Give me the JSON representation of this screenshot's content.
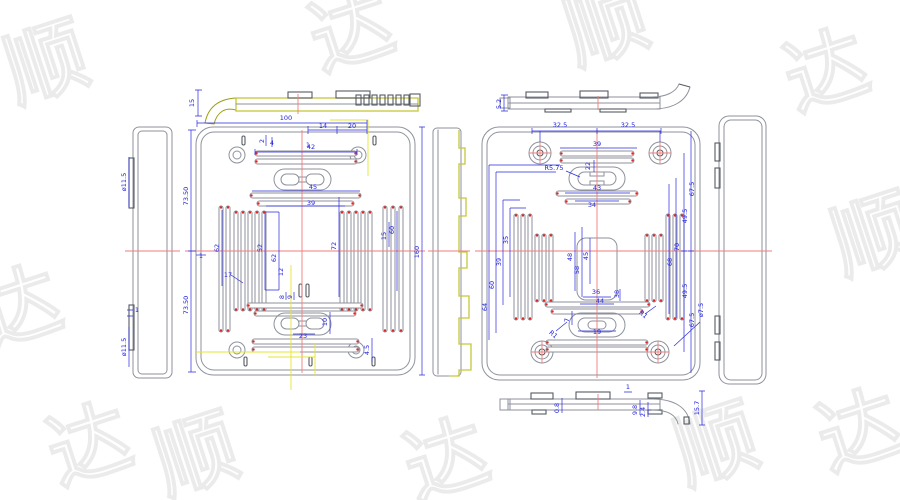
{
  "drawing": {
    "type": "cad-engineering-drawing",
    "parts": [
      "mold-plate-left",
      "mold-plate-right"
    ],
    "colors": {
      "background": "#ffffff",
      "dimension_blue": "#2222dd",
      "geometry_gray": "#8d929b",
      "geometry_dark": "#565b63",
      "highlight_yellow": "#c6c63a",
      "centerline_red": "#f27d7d",
      "marker_red": "#e02424",
      "watermark_gray": "#ebebeb"
    },
    "watermark": {
      "chars": [
        "顺",
        "达"
      ],
      "positions": [
        {
          "x": 55,
          "y": 90,
          "r": -18,
          "c": 0
        },
        {
          "x": 360,
          "y": 58,
          "r": -18,
          "c": 1
        },
        {
          "x": 615,
          "y": 52,
          "r": -18,
          "c": 0
        },
        {
          "x": 835,
          "y": 98,
          "r": -18,
          "c": 1
        },
        {
          "x": 28,
          "y": 335,
          "r": -18,
          "c": 1
        },
        {
          "x": 882,
          "y": 262,
          "r": -18,
          "c": 0
        },
        {
          "x": 205,
          "y": 482,
          "r": -18,
          "c": 0
        },
        {
          "x": 455,
          "y": 487,
          "r": -18,
          "c": 1
        },
        {
          "x": 725,
          "y": 472,
          "r": -18,
          "c": 0
        },
        {
          "x": 98,
          "y": 472,
          "r": -18,
          "c": 1
        },
        {
          "x": 868,
          "y": 458,
          "r": -18,
          "c": 1
        }
      ]
    },
    "dimensions": [
      {
        "t": "15",
        "x": 194,
        "y": 103,
        "r": -90
      },
      {
        "t": "ø11.5",
        "x": 126,
        "y": 182,
        "r": -90
      },
      {
        "t": "1",
        "x": 137,
        "y": 312,
        "r": 0
      },
      {
        "t": "ø11.5",
        "x": 126,
        "y": 347,
        "r": -90
      },
      {
        "t": "100",
        "x": 286,
        "y": 120,
        "r": 0
      },
      {
        "t": "14",
        "x": 323,
        "y": 128,
        "r": 0
      },
      {
        "t": "20",
        "x": 352,
        "y": 128,
        "r": 0
      },
      {
        "t": "2",
        "x": 264,
        "y": 141,
        "r": -90
      },
      {
        "t": "4",
        "x": 272,
        "y": 145,
        "r": 0
      },
      {
        "t": "1",
        "x": 308,
        "y": 147,
        "r": 0
      },
      {
        "t": "42",
        "x": 311,
        "y": 149,
        "r": 0
      },
      {
        "t": "1",
        "x": 201,
        "y": 258,
        "r": 0
      },
      {
        "t": "45",
        "x": 313,
        "y": 189,
        "r": 0
      },
      {
        "t": "39",
        "x": 311,
        "y": 205,
        "r": 0
      },
      {
        "t": "62",
        "x": 219,
        "y": 248,
        "r": -90
      },
      {
        "t": "52",
        "x": 262,
        "y": 248,
        "r": -90
      },
      {
        "t": "62",
        "x": 276,
        "y": 258,
        "r": -90
      },
      {
        "t": "12",
        "x": 283,
        "y": 272,
        "r": -90
      },
      {
        "t": "17",
        "x": 228,
        "y": 277,
        "r": 0
      },
      {
        "t": "72",
        "x": 336,
        "y": 246,
        "r": -90
      },
      {
        "t": "15",
        "x": 386,
        "y": 236,
        "r": -90
      },
      {
        "t": "60",
        "x": 394,
        "y": 230,
        "r": -90
      },
      {
        "t": "160",
        "x": 419,
        "y": 252,
        "r": -90
      },
      {
        "t": "73.50",
        "x": 188,
        "y": 196,
        "r": -90
      },
      {
        "t": "73.50",
        "x": 188,
        "y": 305,
        "r": -90
      },
      {
        "t": "8",
        "x": 284,
        "y": 297,
        "r": -90
      },
      {
        "t": "9",
        "x": 292,
        "y": 297,
        "r": -90
      },
      {
        "t": "10",
        "x": 327,
        "y": 322,
        "r": -90
      },
      {
        "t": "23",
        "x": 303,
        "y": 338,
        "r": 0
      },
      {
        "t": "4.5",
        "x": 369,
        "y": 350,
        "r": -90
      },
      {
        "t": "5.2",
        "x": 501,
        "y": 104,
        "r": -90
      },
      {
        "t": "32.5",
        "x": 560,
        "y": 127,
        "r": 0
      },
      {
        "t": "32.5",
        "x": 628,
        "y": 127,
        "r": 0
      },
      {
        "t": "39",
        "x": 597,
        "y": 146,
        "r": 0
      },
      {
        "t": "R5.75",
        "x": 554,
        "y": 170,
        "r": 0
      },
      {
        "t": "22",
        "x": 590,
        "y": 166,
        "r": -90
      },
      {
        "t": "43",
        "x": 597,
        "y": 190,
        "r": 0
      },
      {
        "t": "34",
        "x": 592,
        "y": 207,
        "r": 0
      },
      {
        "t": "35",
        "x": 508,
        "y": 240,
        "r": -90
      },
      {
        "t": "39",
        "x": 501,
        "y": 262,
        "r": -90
      },
      {
        "t": "60",
        "x": 494,
        "y": 285,
        "r": -90
      },
      {
        "t": "64",
        "x": 487,
        "y": 307,
        "r": -90
      },
      {
        "t": "48",
        "x": 572,
        "y": 257,
        "r": -90
      },
      {
        "t": "58",
        "x": 579,
        "y": 270,
        "r": -90
      },
      {
        "t": "45",
        "x": 588,
        "y": 256,
        "r": -90
      },
      {
        "t": "36",
        "x": 596,
        "y": 294,
        "r": 0
      },
      {
        "t": "44",
        "x": 600,
        "y": 303,
        "r": 0
      },
      {
        "t": "38",
        "x": 619,
        "y": 294,
        "r": -90
      },
      {
        "t": "67.5",
        "x": 694,
        "y": 189,
        "r": -90
      },
      {
        "t": "49.5",
        "x": 687,
        "y": 216,
        "r": -90
      },
      {
        "t": "70",
        "x": 679,
        "y": 247,
        "r": -90
      },
      {
        "t": "68",
        "x": 672,
        "y": 262,
        "r": -90
      },
      {
        "t": "49.5",
        "x": 687,
        "y": 291,
        "r": -90
      },
      {
        "t": "67.5",
        "x": 694,
        "y": 320,
        "r": -90
      },
      {
        "t": "ø7.5",
        "x": 703,
        "y": 310,
        "r": -90
      },
      {
        "t": "R1",
        "x": 552,
        "y": 336,
        "r": 40
      },
      {
        "t": "R1",
        "x": 642,
        "y": 316,
        "r": 40
      },
      {
        "t": "7",
        "x": 569,
        "y": 320,
        "r": -90
      },
      {
        "t": "19",
        "x": 597,
        "y": 334,
        "r": 0
      },
      {
        "t": "0.8",
        "x": 559,
        "y": 408,
        "r": -90
      },
      {
        "t": "1",
        "x": 628,
        "y": 389,
        "r": 0
      },
      {
        "t": "9.8",
        "x": 637,
        "y": 410,
        "r": -90
      },
      {
        "t": "2.4",
        "x": 645,
        "y": 412,
        "r": -90
      },
      {
        "t": "15.7",
        "x": 699,
        "y": 408,
        "r": -90
      }
    ]
  }
}
